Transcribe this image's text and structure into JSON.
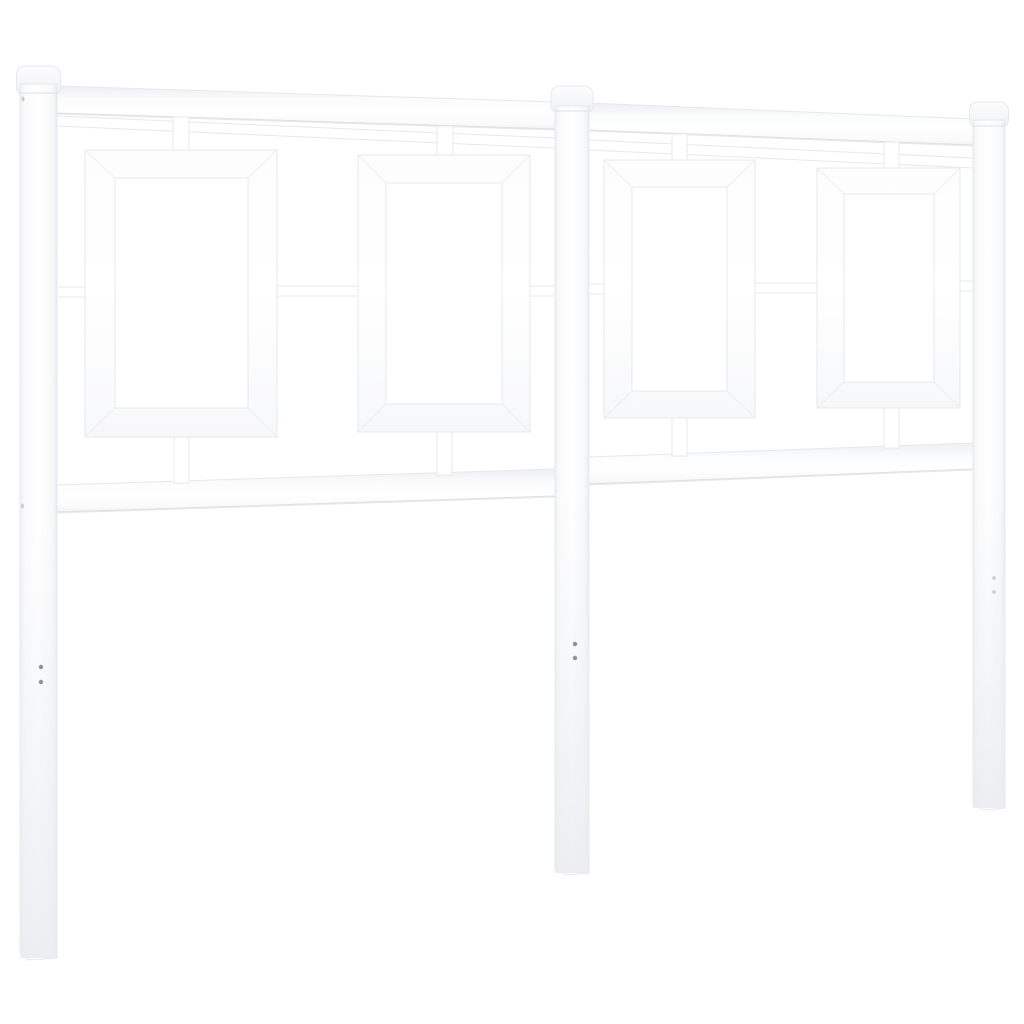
{
  "scene": {
    "alt_text": "White metal headboard photographed on a white background",
    "description": "Frontal product photo, slight left-to-right perspective: left side larger, right side smaller",
    "background_color": "#ffffff"
  },
  "palette": {
    "background": "#ffffff",
    "metal_white": "#ffffff",
    "edge_light": "#e7e8eb",
    "edge_shadow": "#dde0e4",
    "miter_line": "#edeef1",
    "surface_tint": "#f0f1f4",
    "screw_hole": "#8f9196",
    "side_hole": "#c9cace"
  },
  "headboard": {
    "post_count": 3,
    "post_caps": "rounded",
    "panel_count": 4,
    "panel_shape": "open rectangle",
    "top_rails": 2,
    "thin_rails": 2,
    "bottom_rails": 2,
    "top_stub_count": 4,
    "bottom_stub_count": 4,
    "mid_connector_count": 6,
    "screw_hole_pairs": 3
  }
}
